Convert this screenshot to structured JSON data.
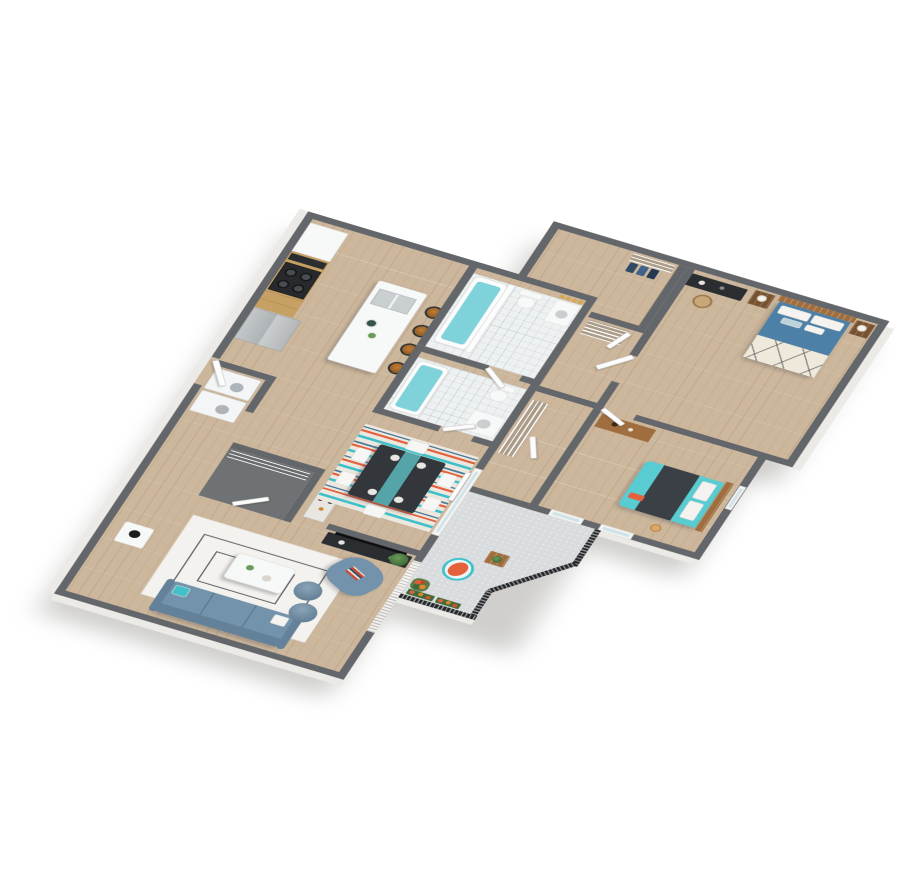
{
  "scene": {
    "type": "3d-floorplan-cutaway-render",
    "view": "isometric",
    "background": "#ffffff",
    "unit_style": "two-bedroom-two-bath-apartment-with-balcony"
  },
  "palette": {
    "wall_cap": "#63666a",
    "wall_face": "#eceae6",
    "wood_floor": "#ccb79c",
    "closet_floor": "#6f7274",
    "balcony_floor": "#d9dcde",
    "tile_floor": "#eef1f2",
    "water": "#7fd2da",
    "counter": "#f7f8f8",
    "cabinet_wood": "#c7a164",
    "stainless": "#b7bcbf",
    "charcoal": "#2b2e31",
    "stool": "#b26f2c",
    "sofa": "#7293ab",
    "accent_teal": "#3fc1c9",
    "accent_coral": "#e5603c",
    "bed_blue": "#4d80a6",
    "bed_teal": "#59ccd2",
    "blanket_dark": "#3b4046",
    "wood_mid": "#a06e3e",
    "rug": "#f3f2ee",
    "door": "#fcfcfc",
    "railing": "#26282b",
    "glass": "#cfe3ea",
    "brass": "#d8a74b",
    "plant": "#4e7d46",
    "navy": "#2e4a66"
  },
  "rooms": [
    {
      "name": "kitchen",
      "items": [
        "white-counter",
        "upper-cabinets",
        "microwave",
        "gas-range",
        "refrigerator",
        "island-with-sink",
        "serving-bowls",
        "bar-stools x4"
      ]
    },
    {
      "name": "laundry-closet",
      "items": [
        "washer",
        "dryer"
      ]
    },
    {
      "name": "entry",
      "items": [
        "entry-door",
        "coat-closet-wire-shelving",
        "bar-cart"
      ]
    },
    {
      "name": "bathroom-primary",
      "items": [
        "bathtub-with-shower-curtain",
        "toilet",
        "vanity-sink",
        "vanity-lights x4"
      ]
    },
    {
      "name": "bathroom-hall",
      "items": [
        "bathtub",
        "toilet",
        "vanity-sink"
      ]
    },
    {
      "name": "walk-in-closet",
      "items": [
        "wire-shelving",
        "hanging-clothes x3"
      ]
    },
    {
      "name": "hall-linen-closets",
      "items": [
        "wire-shelving",
        "closet-doors"
      ]
    },
    {
      "name": "primary-bedroom",
      "items": [
        "queen-bed-blue",
        "wood-headboard",
        "pillows",
        "patterned-throw",
        "nightstand x2",
        "cylinder-lamp x2",
        "desk",
        "desk-chair",
        "wall-art x2"
      ]
    },
    {
      "name": "bedroom-2",
      "items": [
        "queen-bed-teal",
        "dark-duvet",
        "dresser",
        "closet-wire-shelving",
        "windows x3"
      ]
    },
    {
      "name": "dining-area",
      "items": [
        "dining-table",
        "table-runner",
        "place-settings x4",
        "dining-chairs x6",
        "striped-rug",
        "sliding-glass-door"
      ]
    },
    {
      "name": "living-room",
      "items": [
        "sofa",
        "throw-pillows",
        "armchair",
        "stacked-books",
        "coffee-table",
        "pouf x2",
        "side-table",
        "black-table-lamp",
        "geometric-rug",
        "tv-console",
        "tv",
        "floor-plant"
      ]
    },
    {
      "name": "balcony",
      "items": [
        "black-slat-railing",
        "privacy-screen",
        "patio-chair-teal-coral",
        "wood-cube-table",
        "potted-plant",
        "planter-boxes x2",
        "flower-pots"
      ]
    }
  ]
}
